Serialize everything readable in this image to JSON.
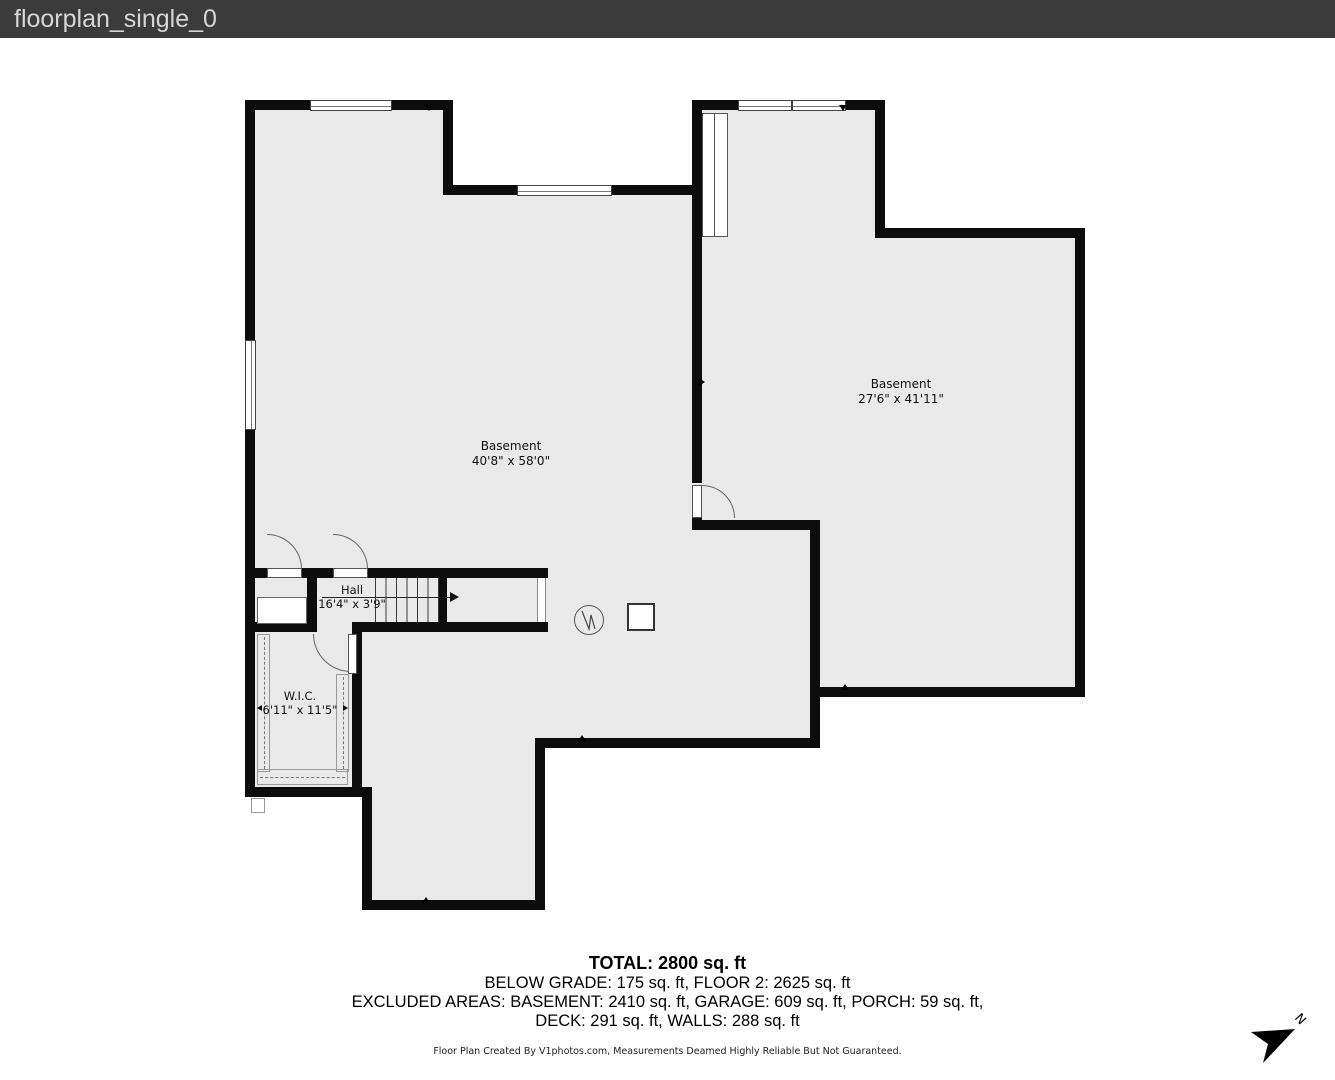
{
  "header": {
    "title": "floorplan_single_0",
    "bg": "#3b3b3b",
    "fg": "#d6d6d6"
  },
  "rooms": {
    "basement_left": {
      "name": "Basement",
      "dims": "40'8\" x 58'0\""
    },
    "basement_right": {
      "name": "Basement",
      "dims": "27'6\" x 41'11\""
    },
    "hall": {
      "name": "Hall",
      "dims": "16'4\" x 3'9\""
    },
    "wic": {
      "name": "W.I.C.",
      "dims": "6'11\" x 11'5\""
    }
  },
  "summary": {
    "total": "TOTAL: 2800 sq. ft",
    "line2": "BELOW GRADE: 175 sq. ft, FLOOR 2: 2625 sq. ft",
    "line3": "EXCLUDED AREAS: BASEMENT: 2410 sq. ft, GARAGE: 609 sq. ft, PORCH: 59 sq. ft,",
    "line4": "DECK: 291 sq. ft, WALLS: 288 sq. ft"
  },
  "footer": {
    "disclaimer": "Floor Plan Created By V1photos.com, Measurements Deamed Highly Reliable But Not Guaranteed."
  },
  "compass": {
    "label": "N"
  },
  "colors": {
    "header_bg": "#3b3b3b",
    "wall": "#0c0c0c",
    "floor_fill": "#e9e9e9"
  }
}
